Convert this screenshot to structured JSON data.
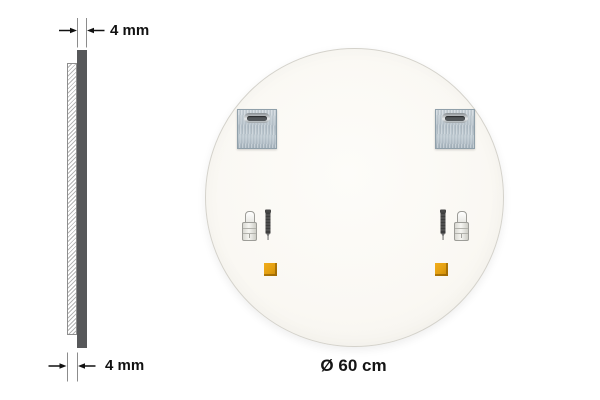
{
  "side_profile": {
    "top_dimension_label": "4 mm",
    "bottom_dimension_label": "4 mm"
  },
  "mirror_back": {
    "diameter_label": "Ø 60 cm"
  },
  "icons": {
    "mounting_plate": "square-metal-plate-with-keyhole-slot",
    "wall_anchor": "wall-plug-dowel",
    "screw": "mounting-screw",
    "adhesive_pad": "orange-adhesive-pad"
  },
  "colors": {
    "background": "#ffffff",
    "mirror_edge_dark": "#57585a",
    "annotation_text": "#111111",
    "plate_metal": "#b8c4cd",
    "slot_dark": "#53575a",
    "pad_orange": "#e29f10",
    "circle_fill": "#faf8f3",
    "circle_border": "#d4d2cb"
  }
}
